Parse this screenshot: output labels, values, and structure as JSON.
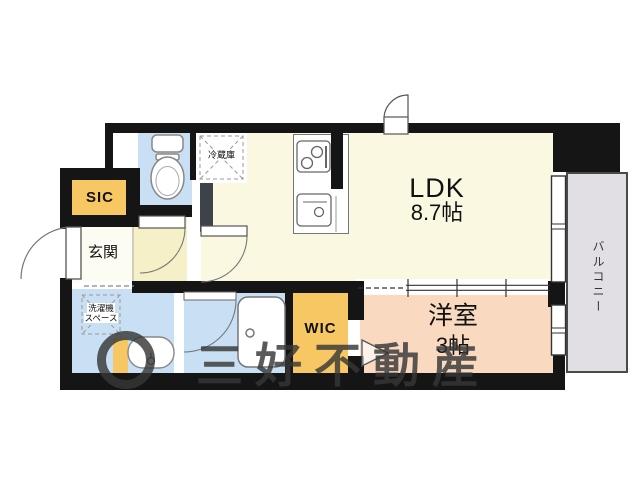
{
  "floorplan": {
    "rooms": {
      "ldk": {
        "label": "LDK",
        "size": "8.7帖",
        "color": "#FAF8E1"
      },
      "western_room": {
        "label": "洋室",
        "size": "3帖",
        "color": "#F9D9BF"
      },
      "wic": {
        "label": "WIC",
        "color": "#F6C763"
      },
      "sic": {
        "label": "SIC",
        "color": "#F6C763"
      },
      "genkan": {
        "label": "玄関",
        "color": "#FDFCF2"
      },
      "balcony": {
        "label": "バルコニー",
        "color": "#E2DFE4"
      },
      "toilet": {
        "color": "#C9E0F4"
      },
      "washroom": {
        "color": "#C9E0F4"
      },
      "bathroom": {
        "color": "#C9E0F4"
      },
      "hallway": {
        "color": "#F5F0C8"
      }
    },
    "annotations": {
      "refrigerator": "冷蔵庫",
      "laundry_line1": "洗濯機",
      "laundry_line2": "スペース"
    },
    "fixtures": [
      "toilet",
      "bathtub",
      "washbasin",
      "gas-stove",
      "kitchen-sink"
    ],
    "watermark": {
      "text": "三好不動産"
    },
    "wall_color": "#151515"
  }
}
